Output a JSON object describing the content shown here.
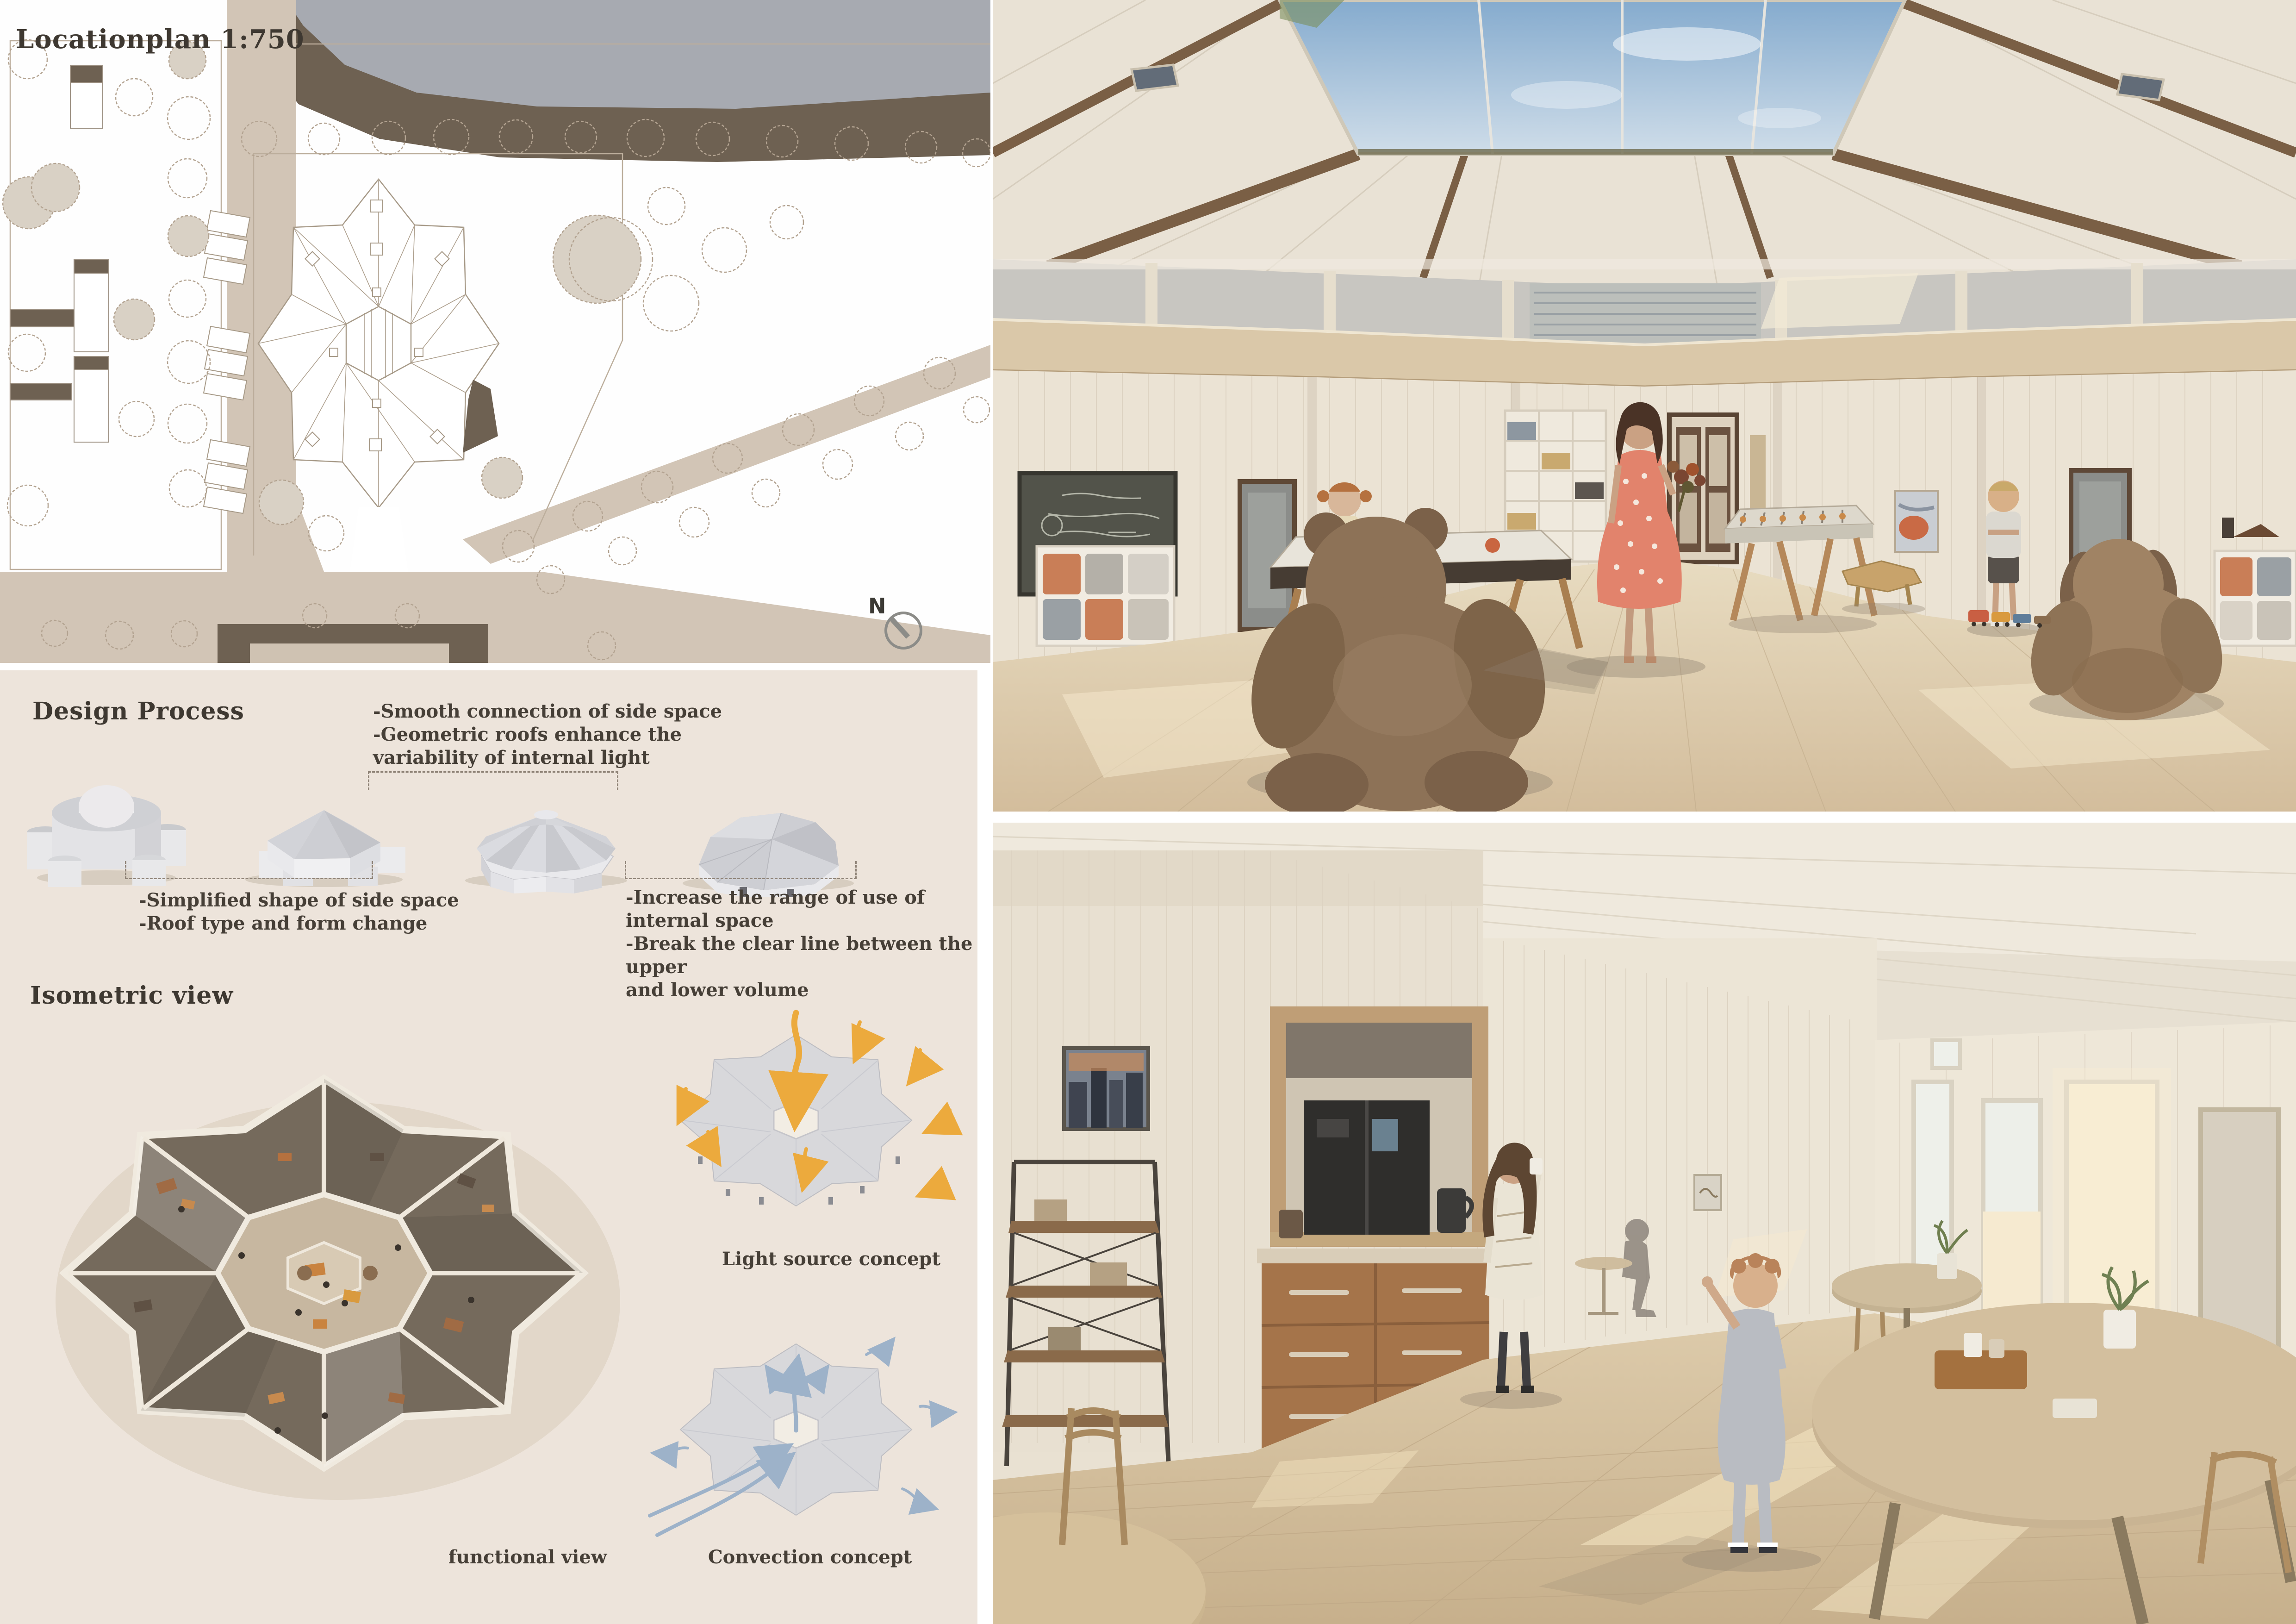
{
  "location_plan": {
    "title": "Locationplan 1:750",
    "compass_label": "N"
  },
  "design_process": {
    "heading": "Design Process",
    "annotation_smooth": [
      "-Smooth connection of side space",
      "-Geometric roofs enhance the",
      "  variability of internal light"
    ],
    "annotation_simplified": [
      "-Simplified shape of side space",
      "-Roof type and form change"
    ],
    "annotation_increase": [
      "-Increase the range of use of internal space",
      "-Break the clear line between the upper",
      "  and lower volume"
    ]
  },
  "isometric": {
    "heading": "Isometric view",
    "caption_functional": "functional view",
    "caption_light": "Light source concept",
    "caption_convection": "Convection concept"
  },
  "colors": {
    "panel_background": "#ede4db",
    "heading_text": "#3e3831",
    "plan_road": "#d2c5b6",
    "plan_building": "#6e6152",
    "plan_water": "#a7aab1",
    "light_arrows": "#ecaa3d",
    "convection_arrows": "#9db2c9"
  }
}
